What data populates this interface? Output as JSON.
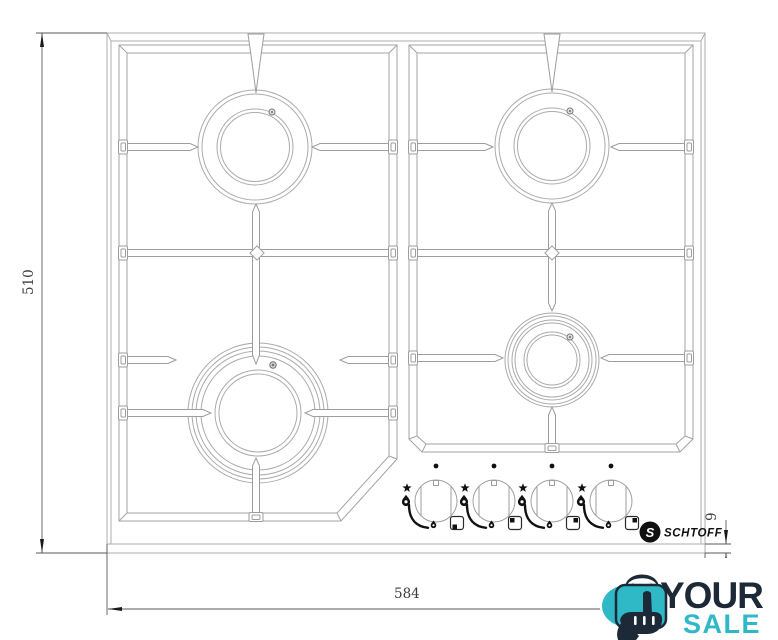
{
  "drawing": {
    "kind": "gas-hob-top-view-technical-drawing",
    "dimensions": {
      "height_mm": "510",
      "width_mm": "584",
      "front_edge_mm": "9"
    },
    "burners": [
      {
        "id": "top-left",
        "size": "medium"
      },
      {
        "id": "top-right",
        "size": "medium"
      },
      {
        "id": "bottom-left",
        "size": "large"
      },
      {
        "id": "bottom-right",
        "size": "small"
      }
    ],
    "knobs": {
      "count": 4,
      "symbols": [
        "position-dot",
        "star",
        "large-flame",
        "small-flame",
        "spark-ignition"
      ]
    }
  },
  "brand": {
    "monogram": "S",
    "name": "SCHTOFF"
  },
  "watermark": {
    "word_top": "YOUR",
    "word_bottom": "SALE",
    "color_teal": "#2fb9c7",
    "color_navy": "#1d2936"
  }
}
